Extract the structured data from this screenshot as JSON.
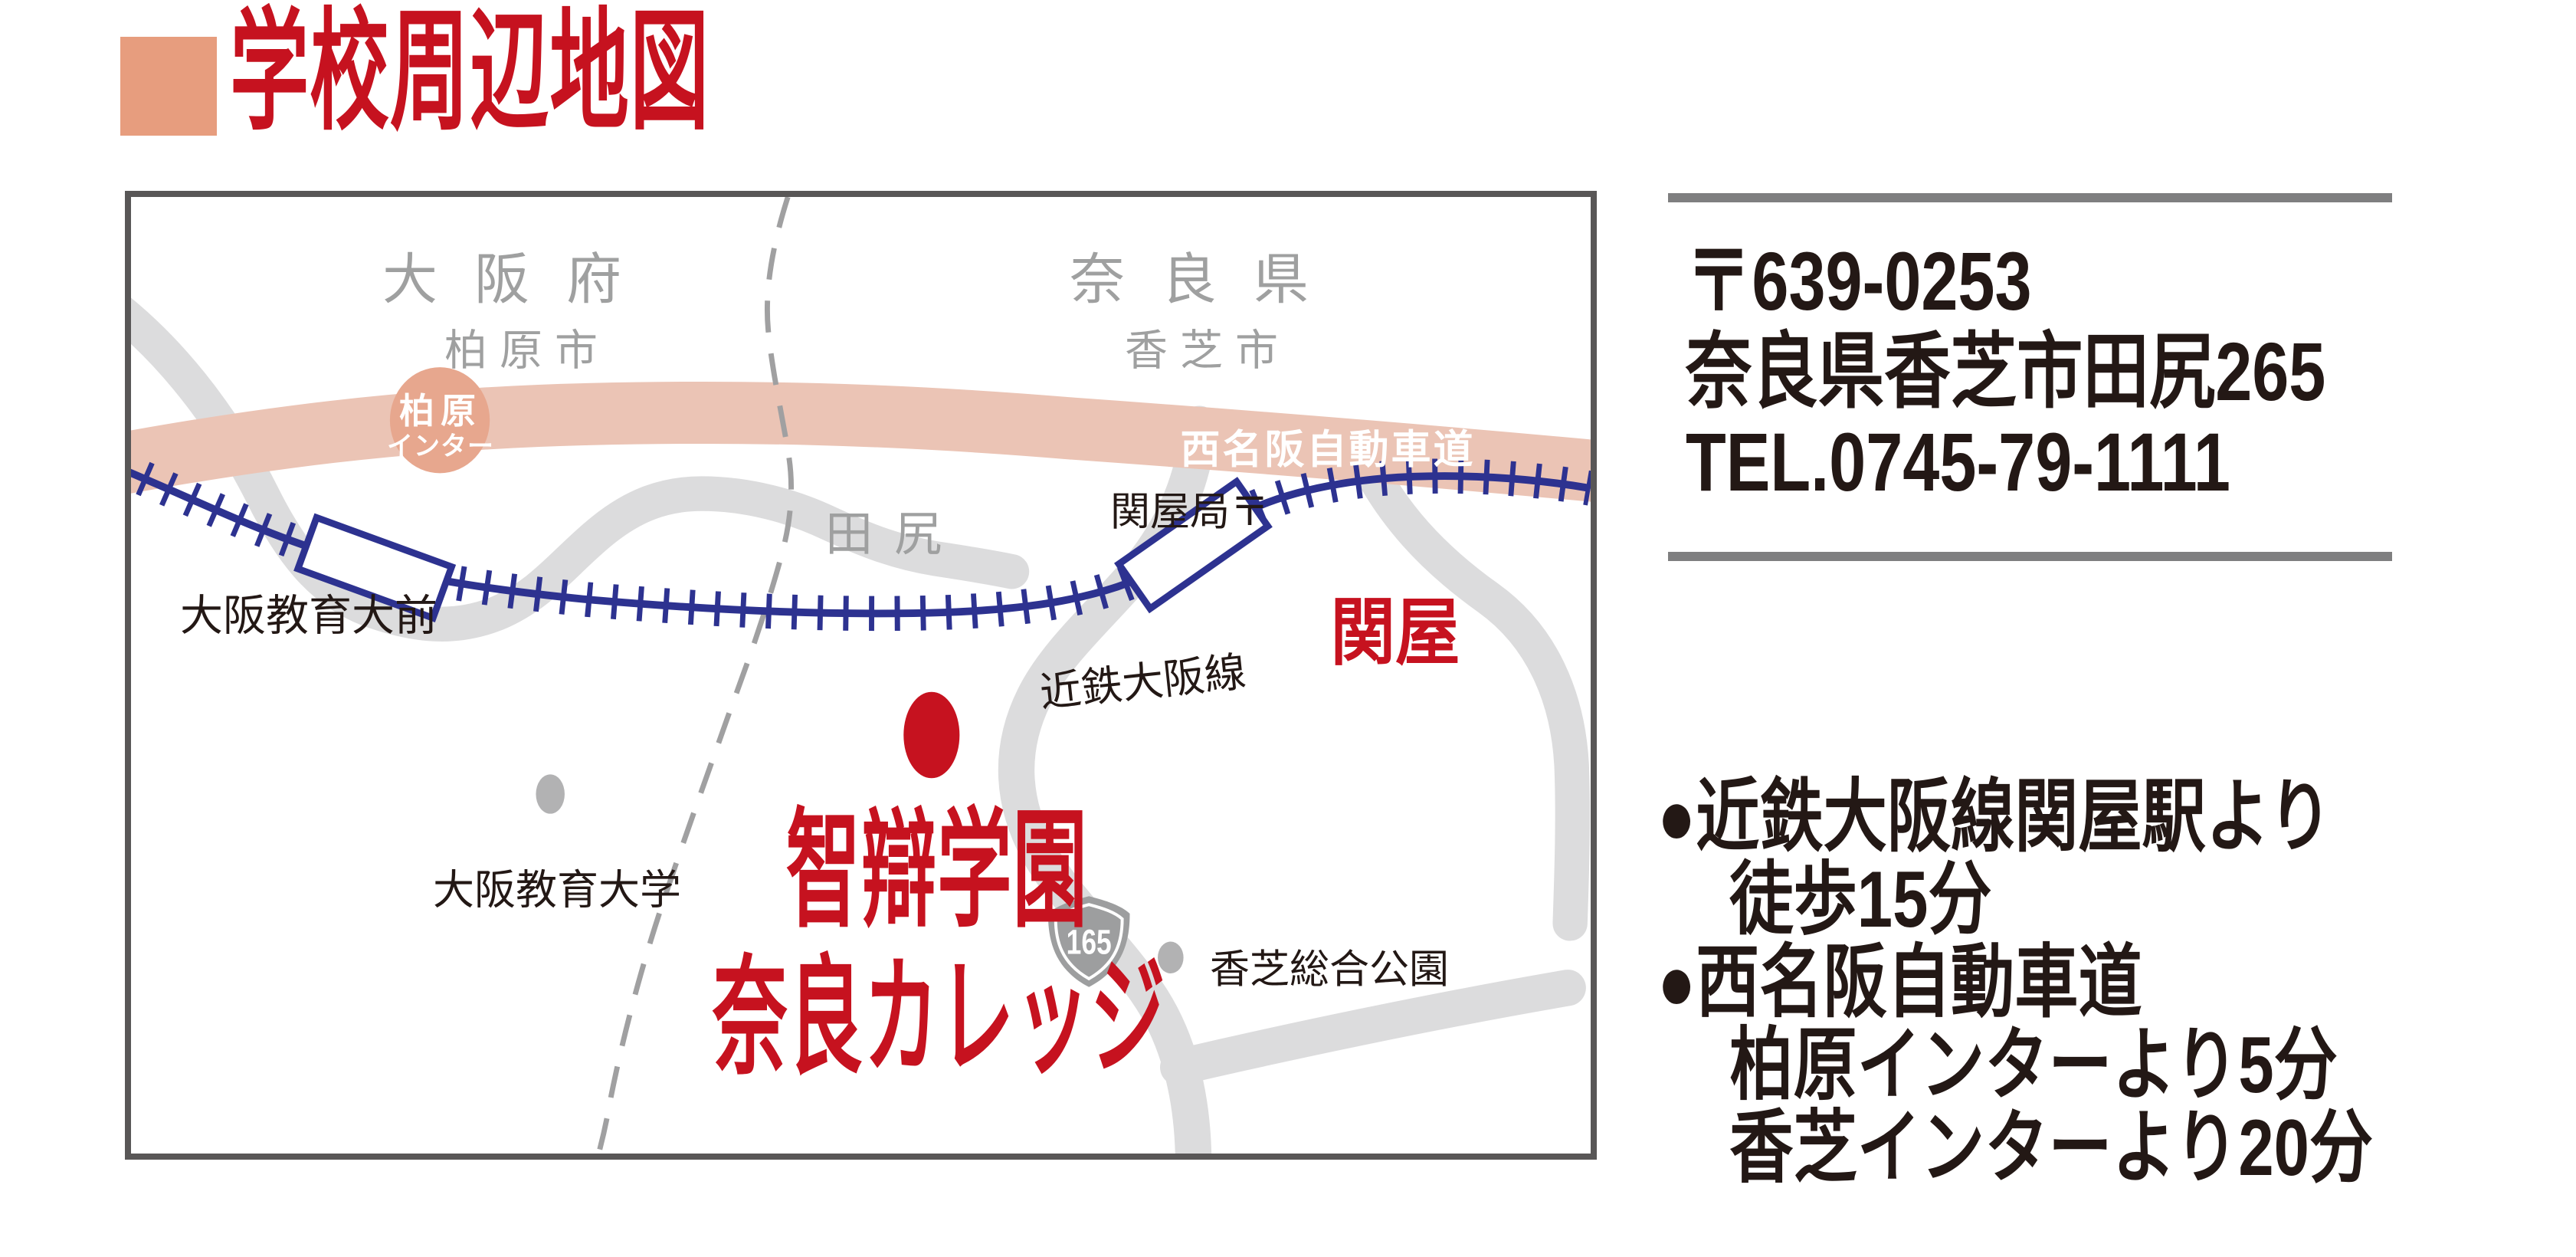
{
  "title": {
    "text": "学校周辺地図"
  },
  "map": {
    "regions": {
      "pref_left": "大阪府",
      "city_left": "柏原市",
      "pref_right": "奈良県",
      "city_right": "香芝市",
      "district": "田尻"
    },
    "expressway": {
      "label": "西名阪自動車道",
      "interchange_line1": "柏原",
      "interchange_line2": "インター"
    },
    "railway": {
      "line_label": "近鉄大阪線",
      "station_west": "大阪教育大前",
      "station_east": "関屋",
      "post_office": "関屋局〒"
    },
    "pois": {
      "university": "大阪教育大学",
      "school_line1": "智辯学園",
      "school_line2": "奈良カレッジ",
      "park": "香芝総合公園"
    },
    "route_shield": {
      "number": "165"
    }
  },
  "info": {
    "postal": "〒639-0253",
    "address": "奈良県香芝市田尻265",
    "tel": "TEL.0745-79-1111",
    "access": [
      "●近鉄大阪線関屋駅より",
      "徒歩15分",
      "●西名阪自動車道",
      "柏原インターより5分",
      "香芝インターより20分"
    ]
  },
  "colors": {
    "accent_red": "#c6121f",
    "title_square_salmon": "#e79d7e",
    "expressway_band": "#ebc4b5",
    "interchange_ellipse": "#e7a78e",
    "road_gray": "#dcdcdd",
    "railway_blue": "#2d3290",
    "region_text_gray": "#9fa0a0",
    "text_black": "#231815",
    "shield_gray": "#9d9e9f",
    "poi_dot_gray": "#b2b2b3",
    "frame_gray": "#595757"
  }
}
